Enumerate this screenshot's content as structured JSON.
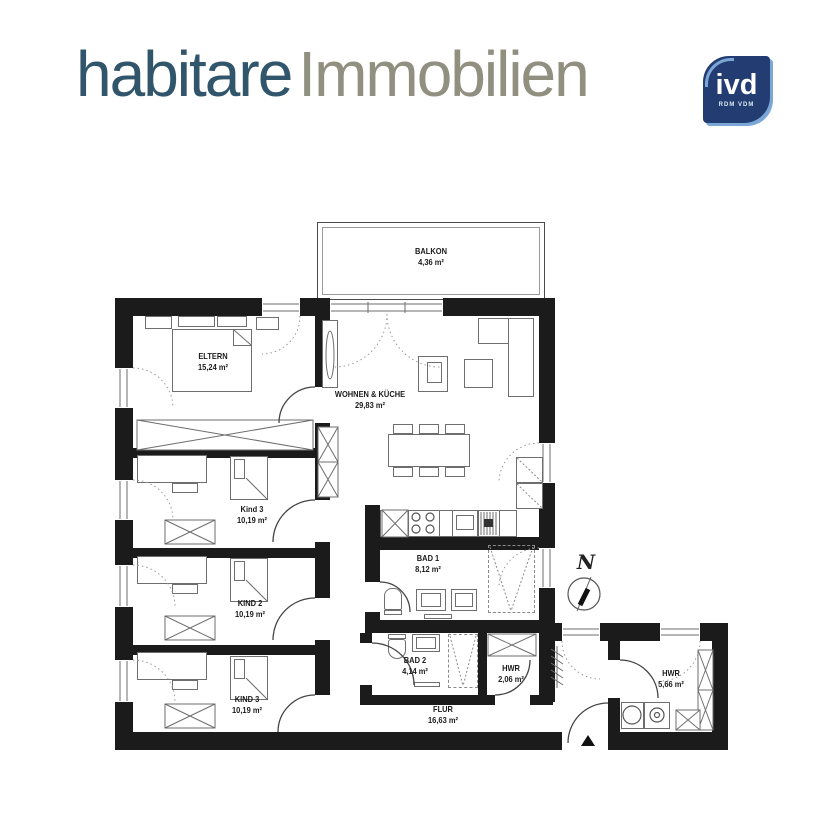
{
  "header": {
    "brand": {
      "primary": "habitare",
      "secondary": "Immobilien"
    },
    "badge": {
      "label": "ivd",
      "sublabel": "RDM VDM"
    },
    "colors": {
      "brand_primary": "#31566c",
      "brand_secondary": "#908f80",
      "badge_bg": "#233d72",
      "badge_accent": "#7ba7d7",
      "wall": "#1b1b1b"
    }
  },
  "floorplan": {
    "compass_label": "N",
    "rooms": [
      {
        "name": "BALKON",
        "area": "4,36 m²"
      },
      {
        "name": "ELTERN",
        "area": "15,24 m²"
      },
      {
        "name": "WOHNEN & KÜCHE",
        "area": "29,83 m²"
      },
      {
        "name": "Kind 3",
        "area": "10,19 m²"
      },
      {
        "name": "KIND 2",
        "area": "10,19 m²"
      },
      {
        "name": "KIND 3",
        "area": "10,19 m²"
      },
      {
        "name": "BAD 1",
        "area": "8,12 m²"
      },
      {
        "name": "BAD 2",
        "area": "4,14 m²"
      },
      {
        "name": "HWR",
        "area": "2,06 m²"
      },
      {
        "name": "FLUR",
        "area": "16,63 m²"
      },
      {
        "name": "HWR",
        "area": "5,66 m²"
      }
    ]
  }
}
